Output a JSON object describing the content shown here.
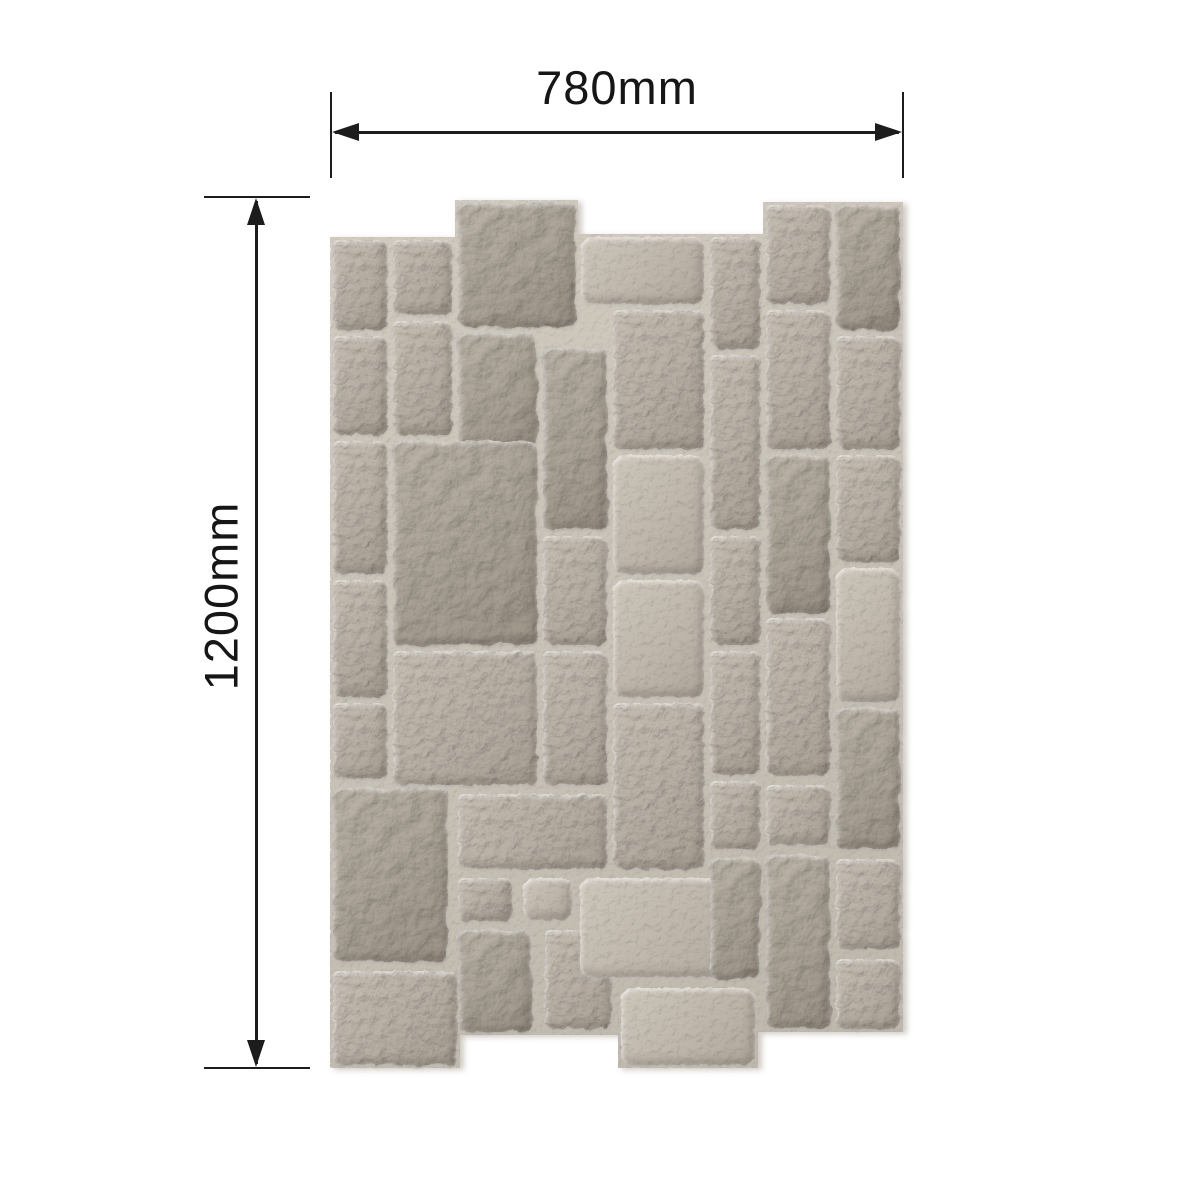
{
  "title": "Stone wall panel dimension diagram",
  "background_color": "#ffffff",
  "dimensions": {
    "line_color": "#1c1c1c",
    "width": {
      "label": "780mm"
    },
    "height": {
      "label": "1200mm"
    }
  },
  "panel": {
    "x": 330,
    "y": 200,
    "width": 573,
    "height": 868,
    "mortar_color": "#c9c2b6",
    "stone_base_color": "#b7afa4",
    "stone_highlight_color": "#d6d0c6",
    "stone_shadow_color": "#8a8378",
    "outline": [
      [
        0,
        37
      ],
      [
        125,
        37
      ],
      [
        125,
        0
      ],
      [
        248,
        0
      ],
      [
        248,
        34
      ],
      [
        433,
        34
      ],
      [
        433,
        2
      ],
      [
        573,
        2
      ],
      [
        573,
        832
      ],
      [
        428,
        832
      ],
      [
        428,
        868
      ],
      [
        288,
        868
      ],
      [
        288,
        835
      ],
      [
        130,
        835
      ],
      [
        130,
        868
      ],
      [
        0,
        868
      ]
    ],
    "stones": [
      [
        0,
        37,
        60,
        96,
        "t1"
      ],
      [
        60,
        37,
        65,
        81,
        "t1"
      ],
      [
        125,
        0,
        123,
        130,
        "t2"
      ],
      [
        248,
        34,
        129,
        73,
        "t3"
      ],
      [
        377,
        34,
        56,
        118,
        "t1"
      ],
      [
        433,
        2,
        70,
        105,
        "t1"
      ],
      [
        503,
        2,
        70,
        131,
        "t2"
      ],
      [
        0,
        133,
        60,
        105,
        "t1"
      ],
      [
        60,
        118,
        65,
        120,
        "t1"
      ],
      [
        125,
        130,
        85,
        122,
        "t2"
      ],
      [
        210,
        145,
        70,
        188,
        "t2"
      ],
      [
        280,
        107,
        97,
        145,
        "t1"
      ],
      [
        377,
        152,
        56,
        181,
        "t1"
      ],
      [
        433,
        107,
        70,
        145,
        "t1"
      ],
      [
        503,
        133,
        70,
        119,
        "t1"
      ],
      [
        0,
        238,
        60,
        139,
        "t1"
      ],
      [
        60,
        238,
        150,
        210,
        "t2"
      ],
      [
        210,
        333,
        70,
        115,
        "t1"
      ],
      [
        280,
        252,
        97,
        125,
        "t3"
      ],
      [
        377,
        333,
        56,
        115,
        "t1"
      ],
      [
        433,
        252,
        70,
        163,
        "t2"
      ],
      [
        503,
        252,
        70,
        113,
        "t1"
      ],
      [
        0,
        377,
        60,
        123,
        "t1"
      ],
      [
        280,
        377,
        97,
        123,
        "t3"
      ],
      [
        433,
        415,
        70,
        163,
        "t1"
      ],
      [
        503,
        365,
        70,
        140,
        "t3"
      ],
      [
        0,
        500,
        60,
        82,
        "t1"
      ],
      [
        60,
        448,
        150,
        140,
        "t1"
      ],
      [
        210,
        448,
        70,
        140,
        "t1"
      ],
      [
        280,
        500,
        97,
        172,
        "t1"
      ],
      [
        503,
        505,
        70,
        147,
        "t2"
      ],
      [
        377,
        448,
        56,
        130,
        "t1"
      ],
      [
        0,
        585,
        120,
        180,
        "t2"
      ],
      [
        0,
        768,
        130,
        100,
        "t1"
      ],
      [
        125,
        591,
        155,
        81,
        "t1"
      ],
      [
        125,
        675,
        60,
        49,
        "t1"
      ],
      [
        190,
        675,
        55,
        48,
        "t3"
      ],
      [
        125,
        727,
        80,
        108,
        "t2"
      ],
      [
        212,
        727,
        73,
        105,
        "t1"
      ],
      [
        247,
        675,
        181,
        105,
        "t3"
      ],
      [
        288,
        785,
        140,
        83,
        "t3"
      ],
      [
        377,
        578,
        56,
        74,
        "t1"
      ],
      [
        377,
        655,
        56,
        127,
        "t2"
      ],
      [
        433,
        582,
        70,
        66,
        "t1"
      ],
      [
        433,
        652,
        70,
        180,
        "t2"
      ],
      [
        503,
        656,
        70,
        96,
        "t1"
      ],
      [
        503,
        756,
        70,
        76,
        "t1"
      ]
    ]
  }
}
